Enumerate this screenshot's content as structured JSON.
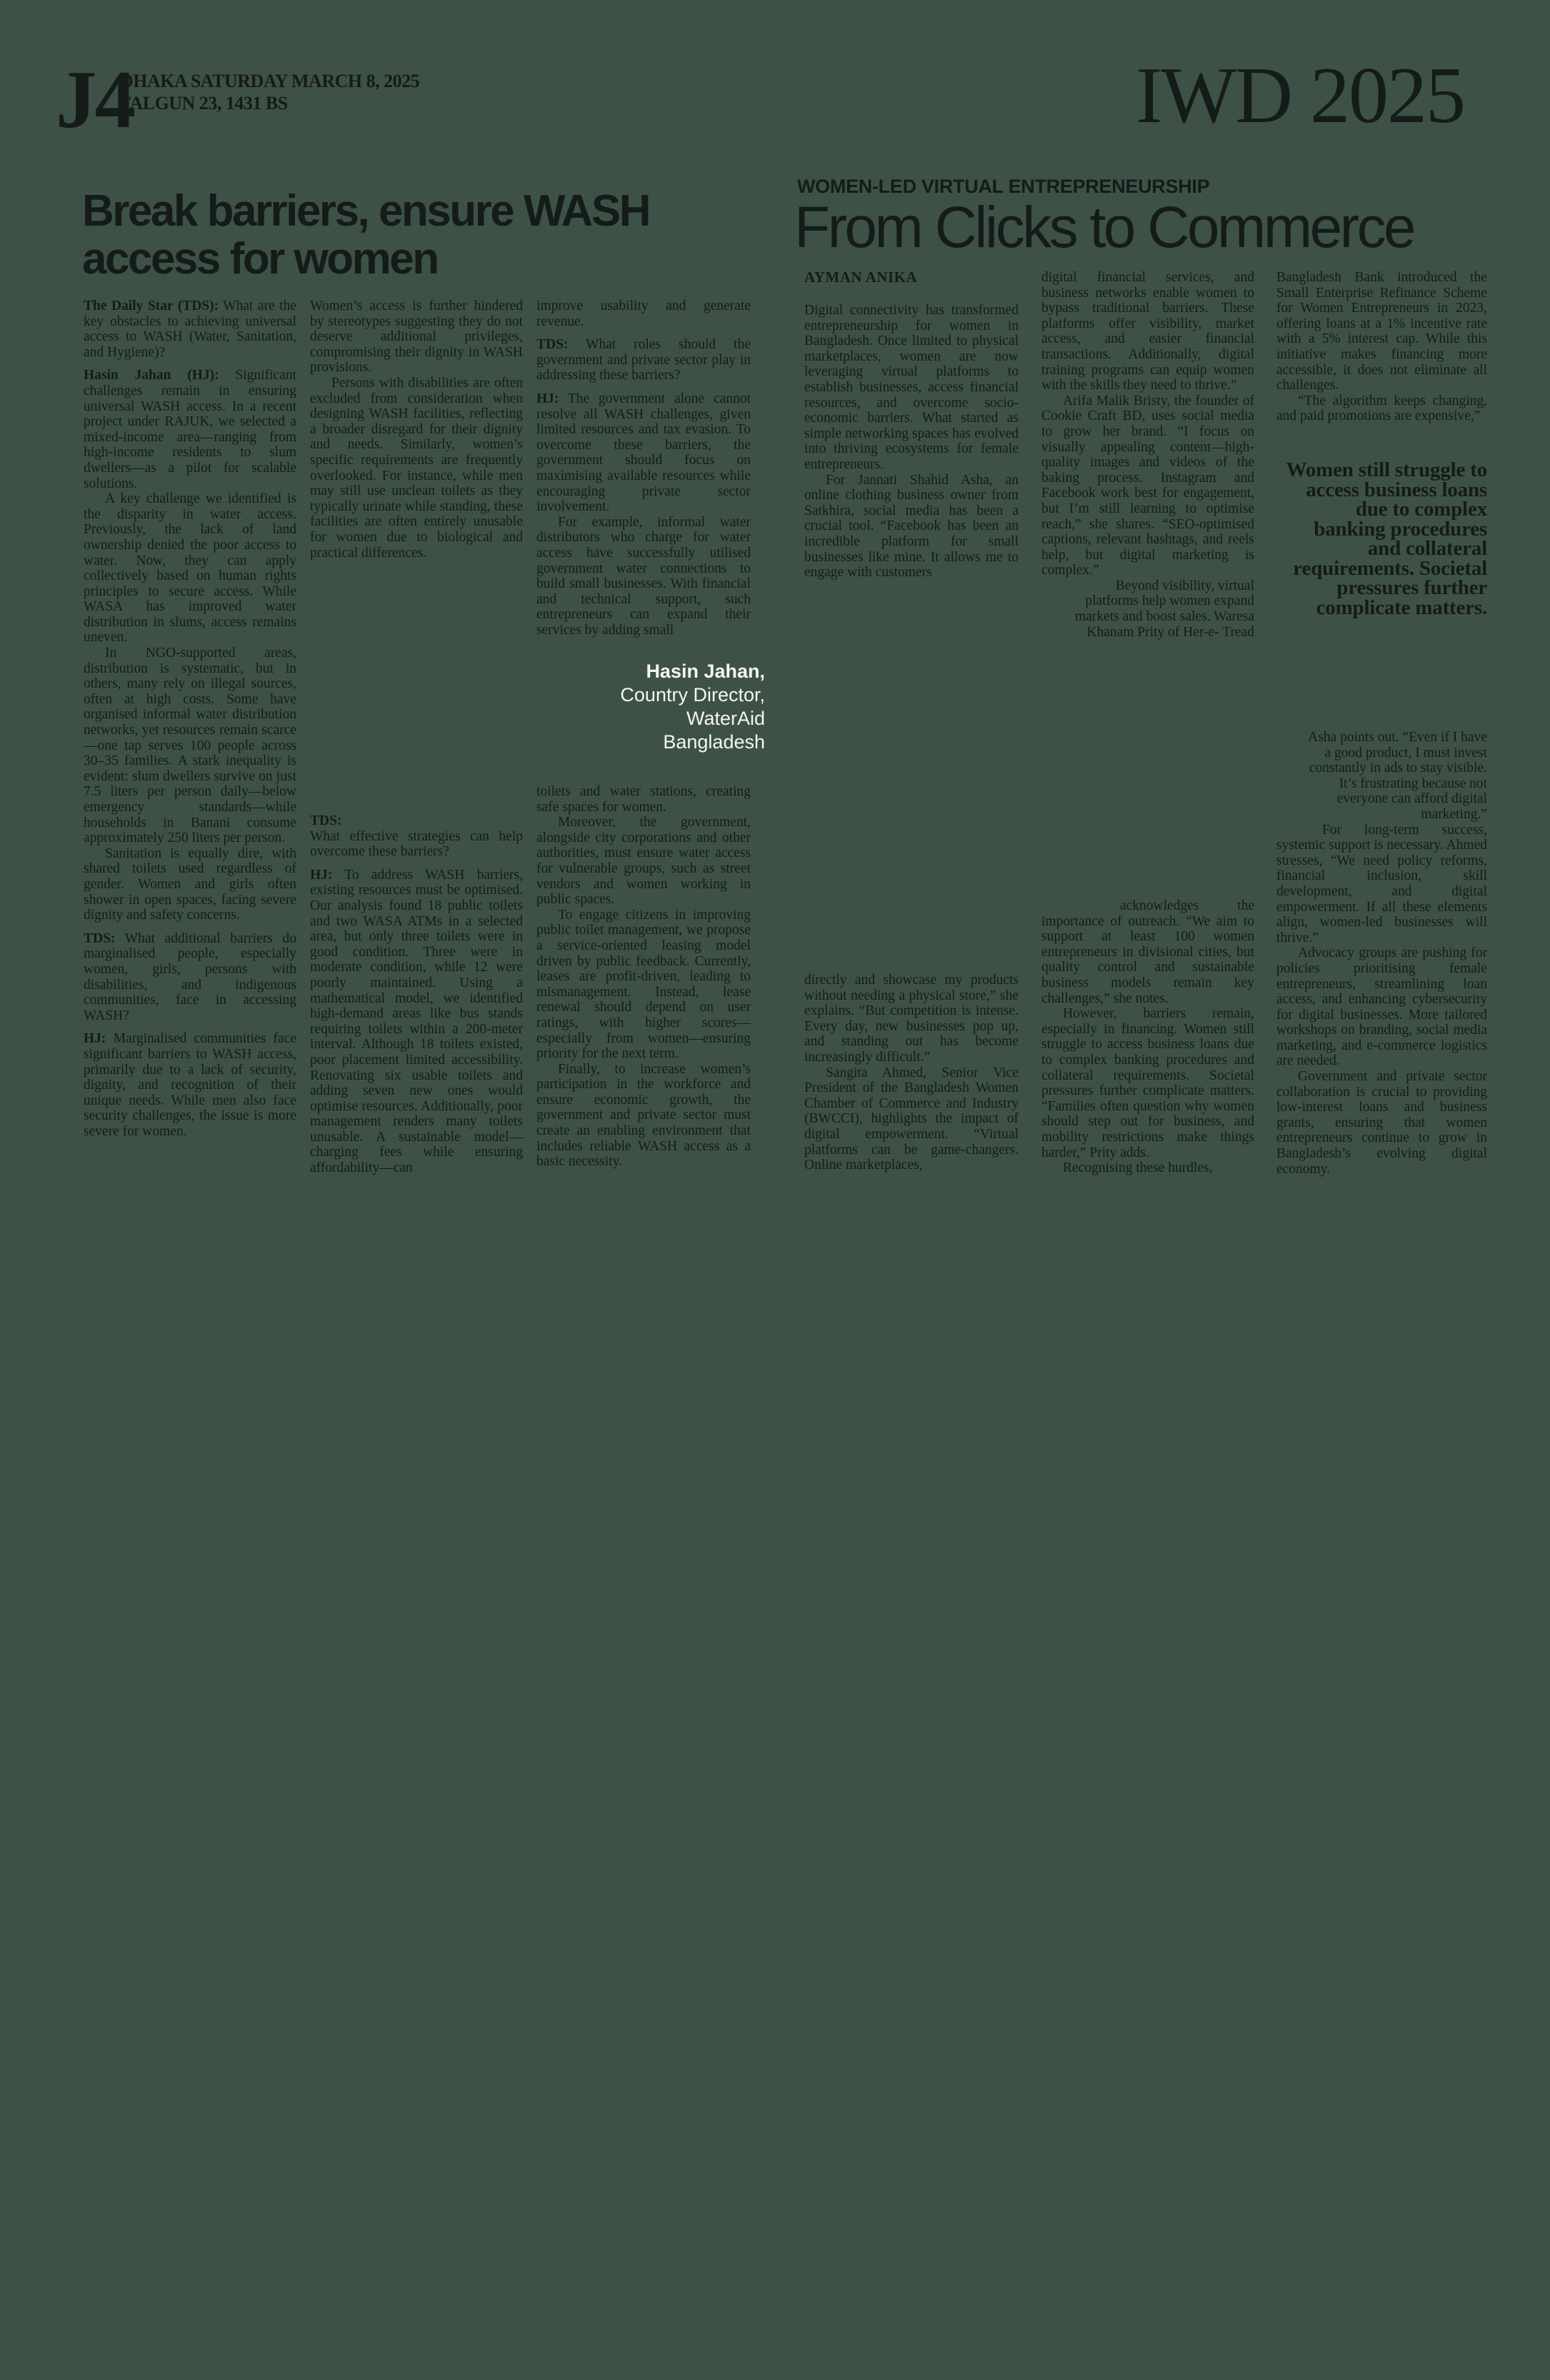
{
  "page": {
    "bg_color": "#3E5147",
    "ink_color": "#151B18",
    "caption_color": "#F3F5F0"
  },
  "masthead": {
    "page_number": "J4",
    "date_line1": "DHAKA SATURDAY MARCH 8, 2025",
    "date_line2": "FALGUN 23, 1431 BS",
    "edition_badge": "IWD 2025"
  },
  "wash_article": {
    "title": "Break barriers, ensure WASH access for women",
    "col1": [
      {
        "lead": "The Daily Star (TDS):",
        "text": "What are the key obstacles to achieving universal access to WASH (Water, Sanitation, and Hygiene)?",
        "style": ""
      },
      {
        "lead": "Hasin Jahan (HJ):",
        "text": "Significant challenges remain in ensuring universal WASH access. In a recent project under RAJUK, we selected a mixed-income area—ranging from high-income residents to slum dwellers—as a pilot for scalable solutions.",
        "style": "qa"
      },
      {
        "text": "A key challenge we identified is the disparity in water access. Previously, the lack of land ownership denied the poor access to water. Now, they can apply collectively based on human rights principles to secure access. While WASA has improved water distribution in slums, access remains uneven.",
        "style": "indent"
      },
      {
        "text": "In NGO-supported areas, distribution is systematic, but in others, many rely on illegal sources, often at high costs. Some have organised informal water distribution networks, yet resources remain scarce—one tap serves 100 people across 30–35 families. A stark inequality is evident: slum dwellers survive on just 7.5 liters per person daily—below emergency standards—while households in Banani consume approximately 250 liters per person.",
        "style": "indent"
      },
      {
        "text": "Sanitation is equally dire, with shared toilets used regardless of gender. Women and girls often shower in open spaces, facing severe dignity and safety concerns.",
        "style": "indent"
      },
      {
        "lead": "TDS:",
        "text": "What additional barriers do marginalised people, especially women, girls, persons with disabilities, and indigenous communities, face in accessing WASH?",
        "style": "qa"
      },
      {
        "lead": "HJ:",
        "text": "Marginalised communities face significant barriers to WASH access, primarily due to a lack of security, dignity, and recognition of their unique needs. While men also face security challenges, the issue is more severe for women.",
        "style": "qa"
      }
    ],
    "col2a": [
      {
        "text": "Women’s access is further hindered by stereotypes suggesting they do not deserve additional privileges, compromising their dignity in WASH provisions.",
        "style": ""
      },
      {
        "text": "Persons with disabilities are often excluded from consideration when designing WASH facilities, reflecting a broader disregard for their dignity and needs. Similarly, women’s specific requirements are frequently overlooked. For instance, while men may still use unclean toilets as they typically urinate while standing, these facilities are often entirely unusable for women due to biological and practical differences.",
        "style": "indent"
      }
    ],
    "col2b": [
      {
        "lead": "TDS:",
        "text": "What effective strategies can help overcome these barriers?",
        "style": "leadblock"
      },
      {
        "lead": "HJ:",
        "text": "To address WASH barriers, existing resources must be optimised. Our analysis found 18 public toilets and two WASA ATMs in a selected area, but only three toilets were in good condition. Three were in moderate condition, while 12 were poorly maintained. Using a mathematical model, we identified high-demand areas like bus stands requiring toilets within a 200-meter interval. Although 18 toilets existed, poor placement limited accessibility. Renovating six usable toilets and adding seven new ones would optimise resources. Additionally, poor management renders many toilets unusable. A sustainable model—charging fees while ensuring affordability—can",
        "style": "qa"
      }
    ],
    "col3a": [
      {
        "text": "improve usability and generate revenue.",
        "style": ""
      },
      {
        "lead": "TDS:",
        "text": "What roles should the government and private sector play in addressing these barriers?",
        "style": "qa"
      },
      {
        "lead": "HJ:",
        "text": "The government alone cannot resolve all WASH challenges, given limited resources and tax evasion. To overcome these barriers, the government should focus on maximising available resources while encouraging private sector involvement.",
        "style": "qa"
      },
      {
        "text": "For example, informal water distributors who charge for water access have successfully utilised government water connections to build small businesses. With financial and technical support, such entrepreneurs can expand their services by adding small",
        "style": "indent"
      }
    ],
    "photo_caption": {
      "line1": "Hasin Jahan,",
      "line2": "Country Director,",
      "line3": "WaterAid",
      "line4": "Bangladesh"
    },
    "col3b": [
      {
        "text": "toilets and water stations, creating safe spaces for women.",
        "style": ""
      },
      {
        "text": "Moreover, the government, alongside city corporations and other authorities, must ensure water access for vulnerable groups, such as street vendors and women working in public spaces.",
        "style": "indent"
      },
      {
        "text": "To engage citizens in improving public toilet management, we propose a service-oriented leasing model driven by public feedback. Currently, leases are profit-driven, leading to mismanagement. Instead, lease renewal should depend on user ratings, with higher scores—especially from women—ensuring priority for the next term.",
        "style": "indent"
      },
      {
        "text": "Finally, to increase women’s participation in the workforce and ensure economic growth, the government and private sector must create an enabling environment that includes reliable WASH access as a basic necessity.",
        "style": "indent"
      }
    ]
  },
  "commerce_article": {
    "kicker": "WOMEN-LED VIRTUAL ENTREPRENEURSHIP",
    "title": "From Clicks to Commerce",
    "byline": "AYMAN ANIKA",
    "col1a": [
      {
        "text": "Digital connectivity has transformed entrepreneurship for women in Bangladesh. Once limited to physical marketplaces, women are now leveraging virtual platforms to establish businesses, access financial resources, and overcome socio-economic barriers. What started as simple networking spaces has evolved into thriving ecosystems for female entrepreneurs.",
        "style": ""
      },
      {
        "text": "For Jannati Shahid Asha, an online clothing business owner from Satkhira, social media has been a crucial tool. “Facebook has been an incredible platform for small businesses like mine. It allows me to engage with customers",
        "style": "indent"
      }
    ],
    "col1b": [
      {
        "text": "directly and showcase my products without needing a physical store,” she explains. “But competition is intense. Every day, new businesses pop up, and standing out has become increasingly difficult.”",
        "style": ""
      },
      {
        "text": "Sangita Ahmed, Senior Vice President of the Bangladesh Women Chamber of Commerce and Industry (BWCCI), highlights the impact of digital empowerment. “Virtual platforms can be game-changers. Online marketplaces,",
        "style": "indent"
      }
    ],
    "col2a": [
      {
        "text": "digital financial services, and business networks enable women to bypass traditional barriers. These platforms offer visibility, market access, and easier financial transactions. Additionally, digital training programs can equip women with the skills they need to thrive.”",
        "style": ""
      },
      {
        "text": "Arifa Malik Bristy, the founder of Cookie Craft BD, uses social media to grow her brand. “I focus on visually appealing content—high-quality images and videos of the baking process. Instagram and Facebook work best for engagement, but I’m still learning to optimise reach,” she shares. “SEO-optimised captions, relevant hashtags, and reels help, but digital marketing is complex.”",
        "style": "indent"
      },
      {
        "text": "Beyond visibility, virtual platforms help women expand markets and boost sales. Waresa Khanam Prity of Her-e- Tread",
        "style": "wrap-right"
      }
    ],
    "col2b": [
      {
        "text": "acknowledges the importance of outreach. “We aim to support at least 100 women entrepreneurs in divisional cities, but quality control and sustainable business models remain key challenges,” she notes.",
        "style": "hang"
      },
      {
        "text": "However, barriers remain, especially in financing. Women still struggle to access business loans due to complex banking procedures and collateral requirements. Societal pressures further complicate matters. “Families often question why women should step out for business, and mobility restrictions make things harder,” Prity adds.",
        "style": "indent"
      },
      {
        "text": "Recognising these hurdles,",
        "style": "indent"
      }
    ],
    "col3a": [
      {
        "text": "Bangladesh Bank introduced the Small Enterprise Refinance Scheme for Women Entrepreneurs in 2023, offering loans at a 1% incentive rate with a 5% interest cap. While this initiative makes financing more accessible, it does not eliminate all challenges.",
        "style": ""
      },
      {
        "text": "“The algorithm keeps changing, and paid promotions are expensive,”",
        "style": "indent"
      }
    ],
    "pull_quote": "Women still struggle to access business loans due to complex banking procedures and collateral requirements. Societal pressures further complicate matters.",
    "col3b": [
      {
        "text": "Asha points out. “Even if I have a good product, I must invest constantly in ads to stay visible. It’s frustrating because not everyone can afford digital marketing.”",
        "style": "wrap-right"
      },
      {
        "text": "For long-term success, systemic support is necessary. Ahmed stresses, “We need policy reforms, financial inclusion, skill development, and digital empowerment. If all these elements align, women-led businesses will thrive.”",
        "style": "indent2"
      },
      {
        "text": "Advocacy groups are pushing for policies prioritising female entrepreneurs, streamlining loan access, and enhancing cybersecurity for digital businesses. More tailored workshops on branding, social media marketing, and e-commerce logistics are needed.",
        "style": "indent"
      },
      {
        "text": "Government and private sector collaboration is crucial to providing low-interest loans and business grants, ensuring that women entrepreneurs continue to grow in Bangladesh’s evolving digital economy.",
        "style": "indent"
      }
    ]
  }
}
